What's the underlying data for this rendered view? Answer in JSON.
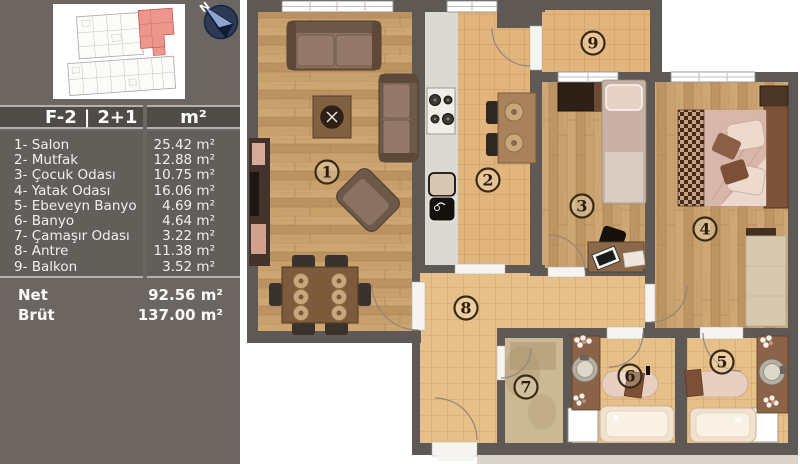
{
  "header": {
    "code": "F-2",
    "divider": "|",
    "type": "2+1",
    "unit": "m²"
  },
  "rooms": [
    {
      "number": "1",
      "label": "1- Salon",
      "area": "25.42 m²"
    },
    {
      "number": "2",
      "label": "2- Mutfak",
      "area": "12.88 m²"
    },
    {
      "number": "3",
      "label": "3- Çocuk Odası",
      "area": "10.75 m²"
    },
    {
      "number": "4",
      "label": "4- Yatak Odası",
      "area": "16.06 m²"
    },
    {
      "number": "5",
      "label": "5- Ebeveyn Banyo",
      "area": "4.69 m²"
    },
    {
      "number": "6",
      "label": "6- Banyo",
      "area": "4.64 m²"
    },
    {
      "number": "7",
      "label": "7- Çamaşır Odası",
      "area": "3.22 m²"
    },
    {
      "number": "8",
      "label": "8- Antre",
      "area": "11.38 m²"
    },
    {
      "number": "9",
      "label": "9- Balkon",
      "area": "3.52 m²"
    }
  ],
  "totals": {
    "net_label": "Net",
    "net_value": "92.56 m²",
    "brut_label": "Brüt",
    "brut_value": "137.00 m²"
  },
  "compass": {
    "label": "N"
  },
  "colors": {
    "sidebar_bg": "#6b6661",
    "header_bar": "#4f4b47",
    "divider_line": "#b3b1ae",
    "wall": "#5e5954",
    "wood_floor": "#c59d69",
    "tile_floor": "#e2b77f",
    "highlight_unit_red": "#ed968d",
    "compass_navy": "#2c3a56",
    "text_light": "#f1f0ee"
  }
}
